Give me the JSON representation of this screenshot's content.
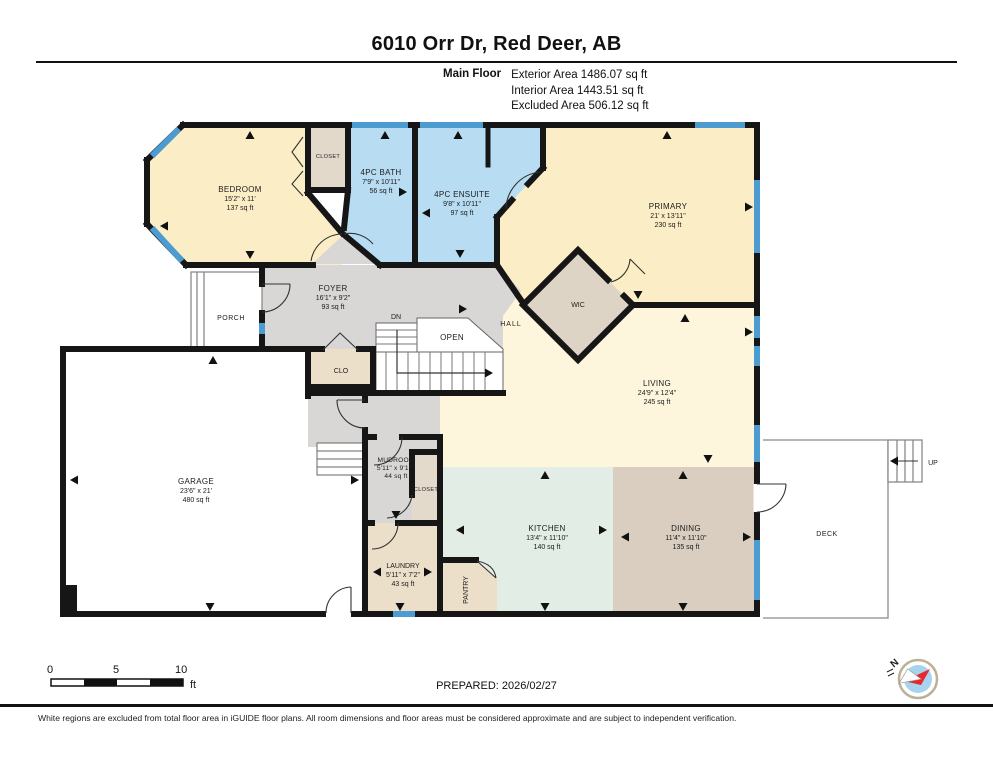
{
  "header": {
    "title": "6010 Orr Dr, Red Deer, AB",
    "floor_label": "Main Floor",
    "stats": [
      "Exterior Area 1486.07 sq ft",
      "Interior Area 1443.51 sq ft",
      "Excluded Area 506.12 sq ft"
    ]
  },
  "rooms": {
    "bedroom": {
      "name": "BEDROOM",
      "dims": "15'2\" x 11'",
      "area": "137 sq ft"
    },
    "closet_bedroom": {
      "name": "CLOSET"
    },
    "bath": {
      "name": "4PC BATH",
      "dims": "7'9\" x 10'11\"",
      "area": "56 sq ft"
    },
    "ensuite": {
      "name": "4PC ENSUITE",
      "dims": "9'8\" x 10'11\"",
      "area": "97 sq ft"
    },
    "primary": {
      "name": "PRIMARY",
      "dims": "21' x 13'11\"",
      "area": "230 sq ft"
    },
    "wic": {
      "name": "WIC"
    },
    "foyer": {
      "name": "FOYER",
      "dims": "16'1\" x 9'2\"",
      "area": "93 sq ft"
    },
    "hall": {
      "name": "HALL"
    },
    "dn": {
      "name": "DN"
    },
    "open": {
      "name": "OPEN"
    },
    "clo": {
      "name": "CLO"
    },
    "porch": {
      "name": "PORCH"
    },
    "garage": {
      "name": "GARAGE",
      "dims": "23'6\" x 21'",
      "area": "480 sq ft"
    },
    "mudroom": {
      "name": "MUDROOM",
      "dims": "5'11\" x 9'10\"",
      "area": "44 sq ft"
    },
    "closet_mudroom": {
      "name": "CLOSET"
    },
    "laundry": {
      "name": "LAUNDRY",
      "dims": "5'11\" x 7'2\"",
      "area": "43 sq ft"
    },
    "pantry": {
      "name": "PANTRY"
    },
    "kitchen": {
      "name": "KITCHEN",
      "dims": "13'4\" x 11'10\"",
      "area": "140 sq ft"
    },
    "dining": {
      "name": "DINING",
      "dims": "11'4\" x 11'10\"",
      "area": "135 sq ft"
    },
    "living": {
      "name": "LIVING",
      "dims": "24'9\" x 12'4\"",
      "area": "245 sq ft"
    },
    "deck": {
      "name": "DECK"
    },
    "up": {
      "name": "UP"
    }
  },
  "scale_bar": {
    "labels": [
      "0",
      "5",
      "10"
    ],
    "unit": "ft"
  },
  "footer": {
    "prepared": "PREPARED: 2026/02/27",
    "disclaimer": "White regions are excluded from total floor area in iGUIDE floor plans. All room dimensions and floor areas must be considered approximate and are subject to independent verification.",
    "compass_label": "N"
  },
  "colors": {
    "wall": "#161616",
    "window": "#4c9cd1",
    "room_yellow": "#fbeec6",
    "room_yellow_light": "#fdf6dd",
    "room_blue": "#b8dcf2",
    "room_gray": "#d8d7d5",
    "room_tan": "#ecdfca",
    "room_tan_dark": "#d9cec0",
    "room_green": "#e2eee5"
  }
}
